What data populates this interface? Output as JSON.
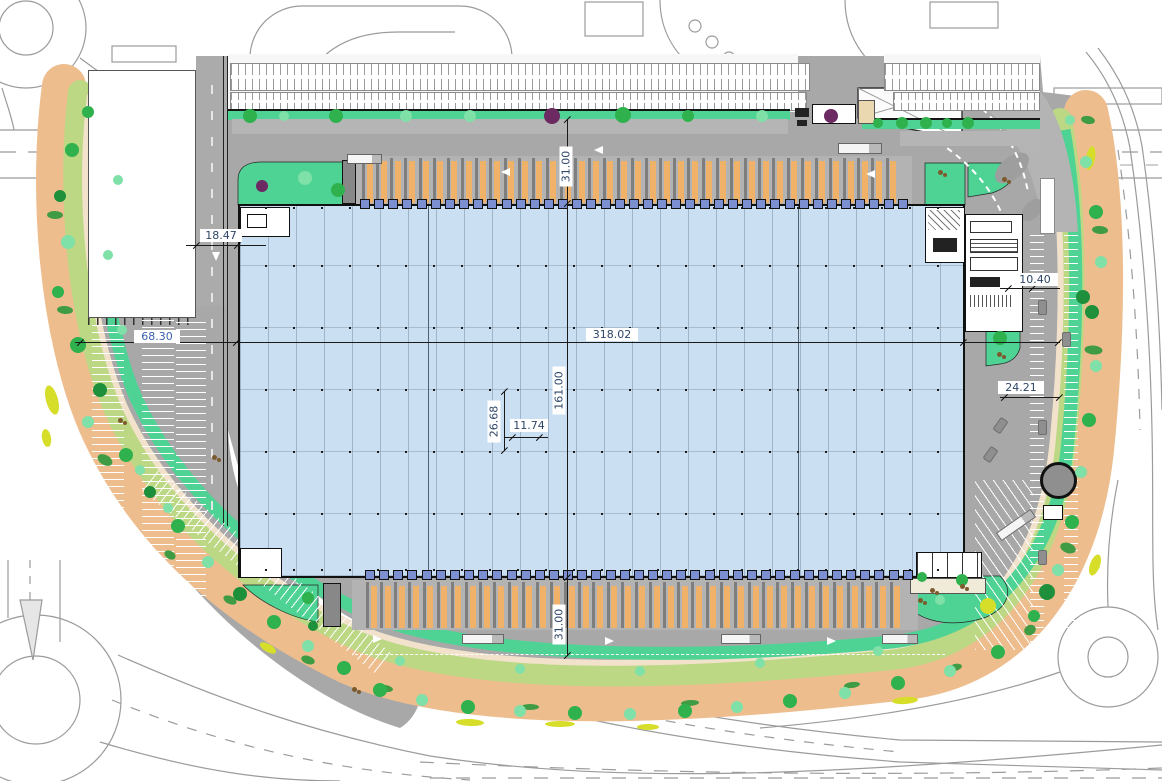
{
  "drawing": {
    "dimensions": {
      "building_length": "318.02",
      "building_depth": "161.00",
      "north_yard_depth": "31.00",
      "south_yard_depth": "31.00",
      "west_access_road": "18.47",
      "west_parking_depth": "68.30",
      "east_annex_depth": "10.40",
      "east_yard_depth": "24.21",
      "grid_bay_depth": "26.68",
      "grid_bay_width": "11.74"
    },
    "colors": {
      "building_fill": "#cbdff2",
      "pavement": "#a8a8a8",
      "landscape_teal": "#4ed395",
      "landscape_orange": "#eebd8e",
      "landscape_mix_green": "#bdd884",
      "walkway_beige": "#f2e2cc",
      "tree_green": "#2fb14e",
      "tree_light": "#7fe0a8",
      "tree_dark": "#1e8f3a",
      "tree_purple": "#6b2a62",
      "shrub_brown": "#7d5a2e",
      "bush_yellow": "#d6de2a",
      "dock_trailer": "#f0b269",
      "dock_divider": "#7e7e7e",
      "dock_door": "#7c8fd0",
      "dim_line": "#1a1a1a",
      "dim_text": "#2e4668",
      "dim_text_blue": "#3a61b0",
      "road_line": "#9b9b9b",
      "grid_line": "#8ca0b4"
    }
  }
}
